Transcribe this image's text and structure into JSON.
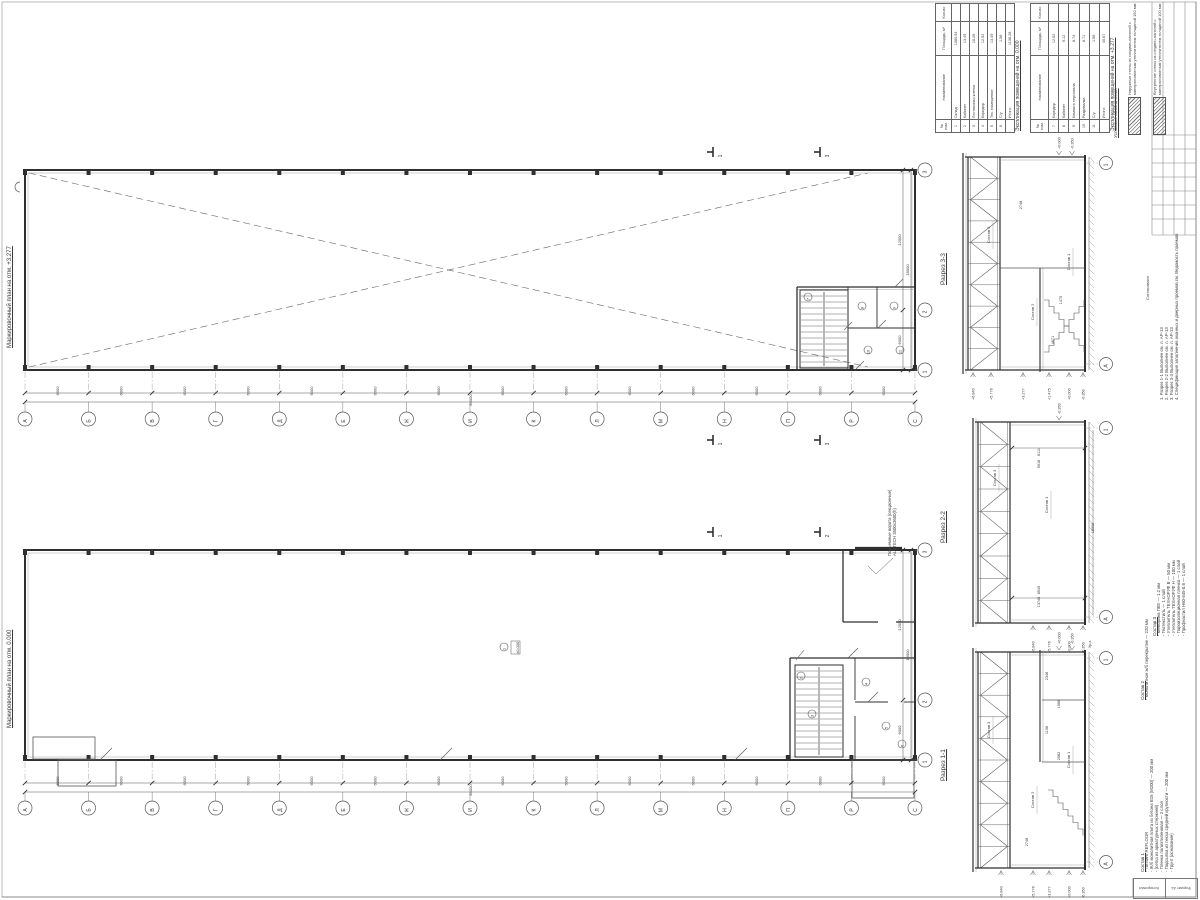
{
  "plans": {
    "upper": {
      "title": "Маркировочный план на отм. +3.277"
    },
    "lower": {
      "title": "Маркировочный план на отм. 0.000"
    },
    "axis_letters": [
      "А",
      "Б",
      "В",
      "Г",
      "Д",
      "Е",
      "Ж",
      "И",
      "К",
      "Л",
      "М",
      "Н",
      "П",
      "Р",
      "С"
    ],
    "axis_numbers": [
      "3",
      "2",
      "1"
    ],
    "bay_dim": "6000",
    "total_dim": "84000",
    "side_chain": [
      "12000",
      "6000"
    ],
    "side_total": "18000",
    "upper_rooms": [
      "7",
      "8",
      "9",
      "10",
      "11"
    ],
    "lower_rooms": [
      "2",
      "3",
      "4",
      "5",
      "6"
    ],
    "hall_room": "1",
    "hall_level": "±0.000",
    "gate_note_1": "Подъемные ворота (секционные)",
    "gate_note_2": "ALUTECH 3500х3600(h)",
    "cut_upper": [
      "3",
      "1"
    ],
    "cut_lower": [
      "2",
      "1"
    ]
  },
  "schedules": [
    {
      "title": "Экспликация помещений на отм. 0.000",
      "headers": [
        "№ пом.",
        "Наименование",
        "Площадь, м²",
        "Кол-во"
      ],
      "rows": [
        [
          "1",
          "Склад",
          "1080.94",
          ""
        ],
        [
          "2",
          "Кабинет",
          "13.49",
          ""
        ],
        [
          "3",
          "Лестничная клетка",
          "16.26",
          ""
        ],
        [
          "4",
          "Коридор",
          "12.52",
          ""
        ],
        [
          "5",
          "Тех. помещение",
          "13.49",
          ""
        ],
        [
          "6",
          "С/у",
          "1.58",
          ""
        ]
      ],
      "total_label": "Итого:",
      "total": "1138.28"
    },
    {
      "title": "Экспликация помещений на отм. +3.277",
      "headers": [
        "№ пом.",
        "Наименование",
        "Площадь, м²",
        "Кол-во"
      ],
      "rows": [
        [
          "7",
          "Коридор",
          "12.52",
          ""
        ],
        [
          "8",
          "Кабинет",
          "9.12",
          ""
        ],
        [
          "9",
          "Комната персонала",
          "8.74",
          ""
        ],
        [
          "10",
          "Раздевалка",
          "8.71",
          ""
        ],
        [
          "11",
          "С/у",
          "1.58",
          ""
        ]
      ],
      "total_label": "Итого:",
      "total": "40.67"
    }
  ],
  "legend": {
    "title": "Условные обозначения",
    "items": [
      "Наружные стены из сэндвич-панелей с минераловатным утеплителем толщиной 150 мм",
      "Внутренние стены из сэндвич-панелей с минераловатным утеплителем толщиной 100 мм"
    ]
  },
  "notes": [
    "1. Разрез 1-1 Выполнен см. л. АР-13",
    "2. Разрез 2-2 Выполнен см. л. АР-13",
    "3. Разрез 3-3 Выполнен см. л. АР-13",
    "4. Спецификация заполнения оконных и дверных проемов см. Ведомость проемов"
  ],
  "compositions": [
    {
      "title": "Состав 3",
      "items": [
        "Мембрана ПВХ — 1.2 мм",
        "Геотекстиль — 1 слой",
        "Утеплитель ТЕХНОРУФ В — 50 мм",
        "Утеплитель ТЕХНОРУФ Н — 100 мм",
        "Пароизоляционная пленка — 1 слой",
        "Профнастил Н60-845-0.8 — 1 слой"
      ]
    },
    {
      "title": "Состав 2",
      "items": [
        "Монолитное ж/б перекрытие — 220 мм"
      ]
    },
    {
      "title": "Состав 1",
      "items": [
        "Топпинг REFLOOR",
        "Ж/б монолитная плита из бетона В15 (М200) — 200 мм",
        "(сетка из арматурных стержней)",
        "Пленка полиэтиленовая — 2 слоя",
        "Подсыпка из песка средней крупности — 200 мм",
        "Грунт (основание)"
      ]
    }
  ],
  "sections": [
    {
      "title": "Разрез 3-3",
      "bubble_top": "1",
      "bubble_bottom": "А",
      "elev_bottom": [
        "+6.840",
        "+5.776",
        "+3.277",
        "+1.475",
        "+0.000",
        "-0.350"
      ],
      "elev_top": [
        "+0.000",
        "-0.350"
      ],
      "dims": [
        "2748",
        "4671",
        "1475"
      ],
      "callouts": [
        "Состав 3",
        "Состав 2",
        "Состав 1"
      ]
    },
    {
      "title": "Разрез 2-2",
      "bubble_top": "1",
      "bubble_bottom": "А",
      "elev_bottom": [
        "+6.840",
        "+5.776",
        "+0.000",
        "-0.350"
      ],
      "elev_top": [
        "-0.350"
      ],
      "dims": [
        "6111",
        "9018",
        "13748",
        "8549",
        "18000"
      ],
      "callouts": [
        "Состав 3",
        "Состав 1"
      ]
    },
    {
      "title": "Разрез 1-1",
      "bubble_top": "1",
      "bubble_bottom": "А",
      "elev_bottom": [
        "+6.840",
        "+5.776",
        "+3.277",
        "+0.000",
        "-0.350"
      ],
      "elev_top": [
        "+0.000",
        "-0.350"
      ],
      "dims": [
        "2348",
        "1568",
        "1108",
        "2082",
        "2748"
      ],
      "callouts": [
        "Состав 3",
        "Состав 2",
        "Состав 1"
      ]
    }
  ],
  "sections_misc": {
    "ground_label": "Ур.з."
  },
  "corner_stamp": {
    "label": "Согласовано"
  },
  "bottom_stamp": {
    "left": "Копировал",
    "right": "Формат А1"
  }
}
